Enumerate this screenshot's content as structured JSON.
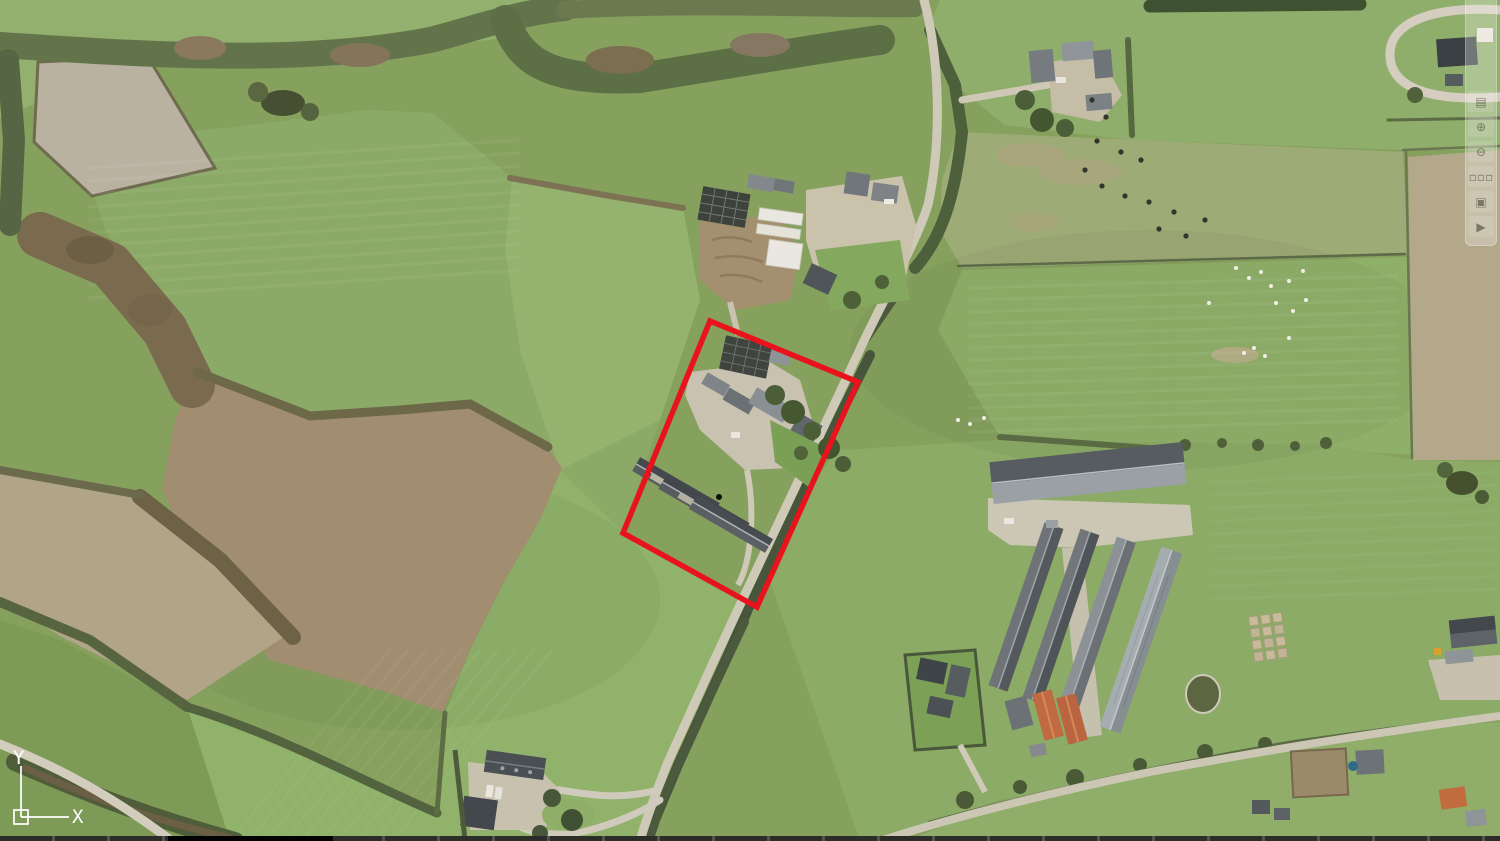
{
  "app": {
    "name": "aerial-imagery-viewer"
  },
  "canvas": {
    "width": 1500,
    "height": 841
  },
  "palette": {
    "annotation_red": "#e8131d",
    "ucs_white": "#ffffff",
    "grass_base": "#86a05e",
    "plowed_brown": "#a18d6f",
    "road_grey": "#cfc9b8",
    "dark_roof": "#474c50",
    "orange_roof": "#bf6a41"
  },
  "parcel_outline": {
    "color": "#e8131d",
    "stroke_width": 5.5,
    "points": [
      [
        710,
        321
      ],
      [
        858,
        382
      ],
      [
        757,
        607
      ],
      [
        623,
        533
      ]
    ]
  },
  "ucs": {
    "x_label": "X",
    "y_label": "Y"
  },
  "toolbar": {
    "buttons": [
      {
        "name": "layers-icon",
        "glyph": "▤"
      },
      {
        "name": "zoom-in-icon",
        "glyph": "⊕"
      },
      {
        "name": "zoom-out-icon",
        "glyph": "⊖"
      },
      {
        "name": "tiles-icon",
        "glyph": "▫▫▫"
      },
      {
        "name": "select-frame-icon",
        "glyph": "▣"
      },
      {
        "name": "play-icon",
        "glyph": "▶"
      }
    ]
  },
  "livestock": {
    "cattle_color": "#32362a",
    "sheep_color": "#f1f0e7",
    "cattle": [
      [
        1092,
        100
      ],
      [
        1106,
        117
      ],
      [
        1097,
        141
      ],
      [
        1121,
        152
      ],
      [
        1141,
        160
      ],
      [
        1085,
        170
      ],
      [
        1102,
        186
      ],
      [
        1125,
        196
      ],
      [
        1149,
        202
      ],
      [
        1174,
        212
      ],
      [
        1159,
        229
      ],
      [
        1186,
        236
      ],
      [
        1205,
        220
      ]
    ],
    "sheep": [
      [
        1236,
        268
      ],
      [
        1249,
        278
      ],
      [
        1261,
        272
      ],
      [
        1271,
        286
      ],
      [
        1289,
        281
      ],
      [
        1303,
        271
      ],
      [
        1306,
        300
      ],
      [
        1293,
        311
      ],
      [
        1276,
        303
      ],
      [
        1209,
        303
      ],
      [
        1289,
        338
      ],
      [
        1254,
        348
      ],
      [
        1265,
        356
      ],
      [
        1244,
        353
      ],
      [
        958,
        420
      ],
      [
        970,
        424
      ],
      [
        984,
        418
      ]
    ]
  },
  "stripes": [
    {
      "name": "central-field-mowing-lines",
      "x1": 88,
      "y1": 168,
      "x2": 520,
      "y2": 140,
      "dx": 0,
      "dy": 13,
      "count": 11,
      "opacity": 0.05
    },
    {
      "name": "right-pasture-mowing-lines",
      "x1": 968,
      "y1": 288,
      "x2": 1398,
      "y2": 276,
      "dx": 0,
      "dy": 12,
      "count": 13,
      "opacity": 0.05
    },
    {
      "name": "se-pasture-mowing-lines",
      "x1": 1210,
      "y1": 482,
      "x2": 1498,
      "y2": 472,
      "dx": 0,
      "dy": 13,
      "count": 10,
      "opacity": 0.035
    },
    {
      "name": "sw-field-tracks",
      "x1": 230,
      "y1": 841,
      "x2": 390,
      "y2": 650,
      "dx": 18,
      "dy": 0,
      "count": 10,
      "opacity": 0.04
    }
  ]
}
